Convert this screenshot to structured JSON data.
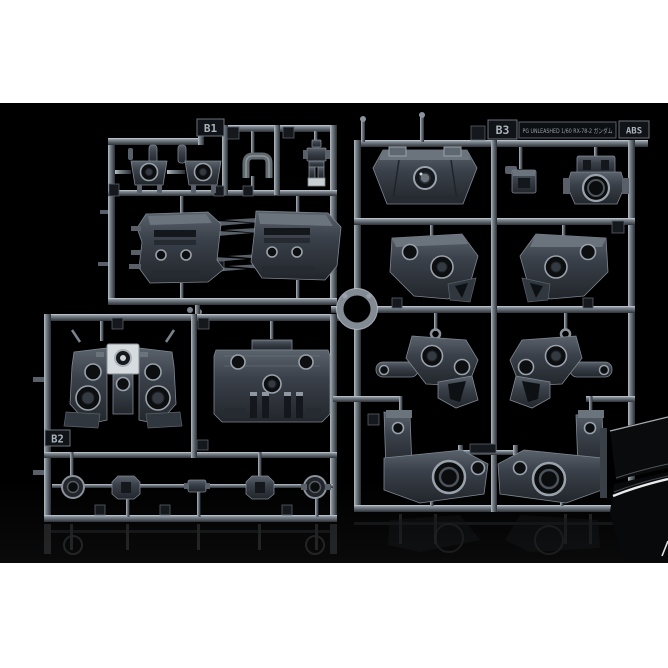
{
  "photo": {
    "kind": "model-kit-runner-product-photo",
    "background_color": "#000000",
    "top_bar_color": "#ffffff",
    "bottom_bar_color": "#ffffff"
  },
  "labels": {
    "runner_b1": "B1",
    "runner_b2": "B2",
    "runner_b3": "B3",
    "kit_title": "PG UNLEASHED 1/60 RX-78-2 ガンダム",
    "material": "ABS"
  },
  "colors": {
    "rail_light": "#c9d1d9",
    "rail_mid": "#848d96",
    "rail_dark": "#2e3338",
    "part_light": "#5a626c",
    "part_mid": "#3a4049",
    "part_dark": "#22262c",
    "tag_background": "#101317",
    "tag_text": "#aab2bb",
    "gloss_highlight": "#e8ebed"
  }
}
